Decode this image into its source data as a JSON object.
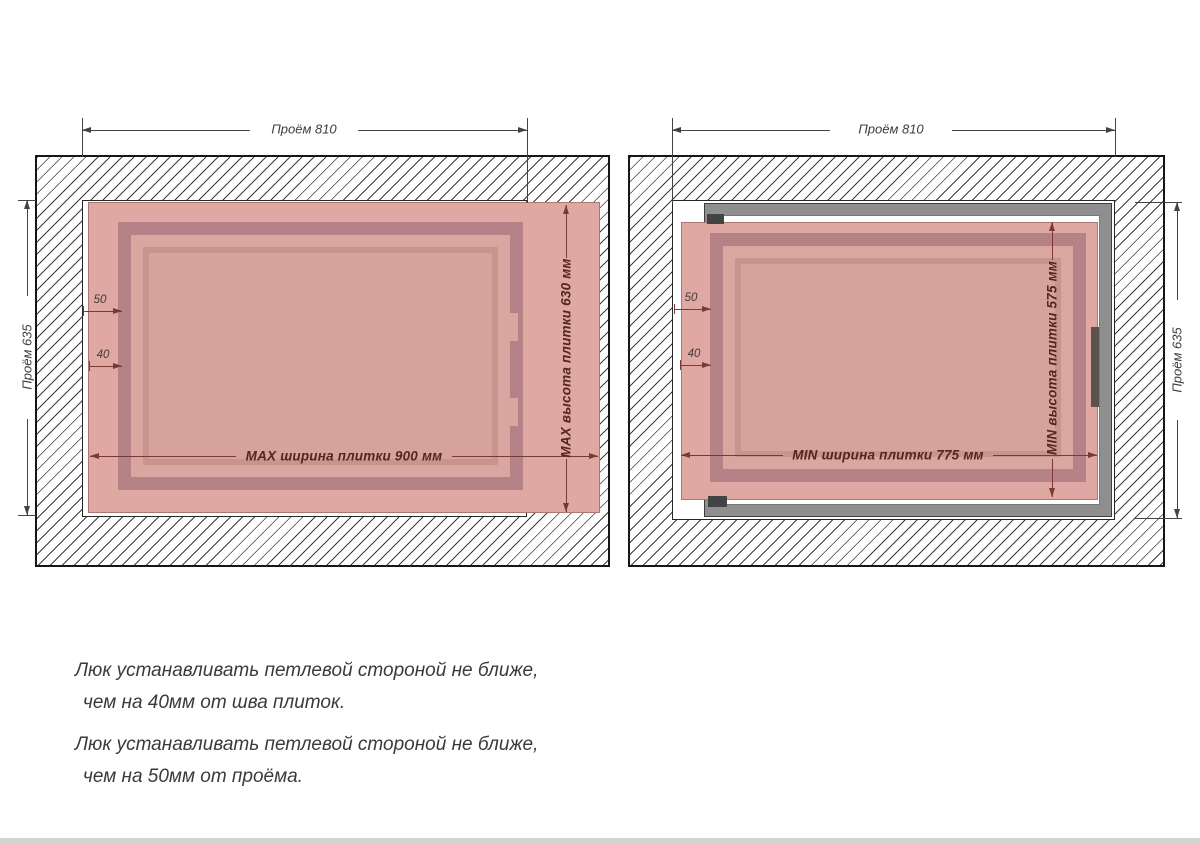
{
  "page": {
    "background": "#ffffff",
    "bottom_bar_color": "#d3d3d3"
  },
  "colors": {
    "tile_pink": "#dfa8a2",
    "hatch_frame_dark_pink": "#b58387",
    "frame_face_pink": "#c7948e",
    "door_panel_pink": "#d7a29b",
    "metal_frame_gray": "#8f8f8f",
    "hinge_dark": "#434343",
    "dimension_maroon": "#7a3a33",
    "dimension_dark": "#434343",
    "note_text_color": "#3a3a3a"
  },
  "diagrams": [
    {
      "name": "max-tile-size",
      "opening_width_label": "Проём 810",
      "opening_height_label": "Проём 635",
      "offset_from_opening_label": "50",
      "offset_from_seam_label": "40",
      "tile_width_label": "MAX ширина плитки 900 мм",
      "tile_height_label": "MAX высота плитки 630 мм"
    },
    {
      "name": "min-tile-size",
      "opening_width_label": "Проём 810",
      "opening_height_label": "Проём 635",
      "offset_from_opening_label": "50",
      "offset_from_seam_label": "40",
      "tile_width_label": "MIN ширина плитки 775 мм",
      "tile_height_label": "MIN высота плитки 575 мм"
    }
  ],
  "notes": [
    {
      "line1": "Люк устанавливать петлевой стороной не ближе,",
      "line2": "чем на 40мм от шва плиток."
    },
    {
      "line1": "Люк устанавливать петлевой стороной не ближе,",
      "line2": "чем на 50мм от проёма."
    }
  ]
}
